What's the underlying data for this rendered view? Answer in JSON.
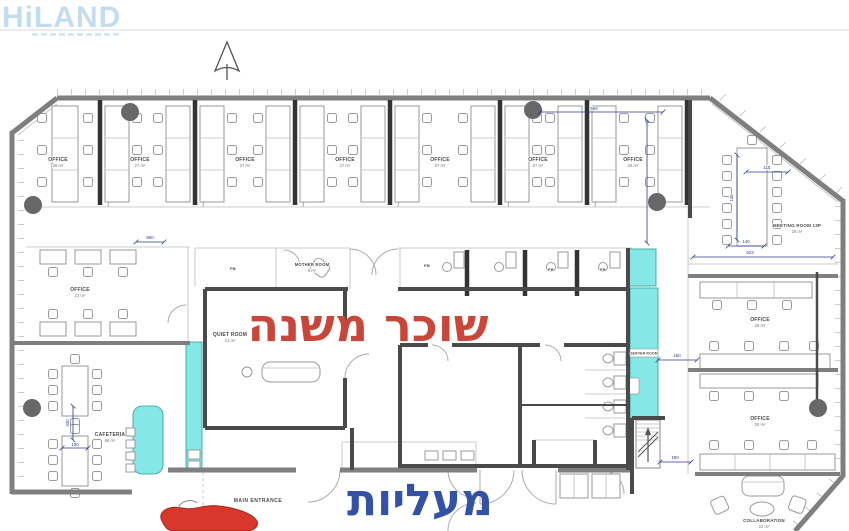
{
  "brand": {
    "logo": "HiLAND"
  },
  "overlay": {
    "subtenant": "שוכר משנה",
    "elevators": "מעליות"
  },
  "labels": {
    "main_entrance": "MAIN ENTRANCE",
    "pb": "PB",
    "top_offices": [
      {
        "name": "OFFICE",
        "area": "28 m²"
      },
      {
        "name": "OFFICE",
        "area": "27 m²"
      },
      {
        "name": "OFFICE",
        "area": "27 m²"
      },
      {
        "name": "OFFICE",
        "area": "27 m²"
      },
      {
        "name": "OFFICE",
        "area": "27 m²"
      },
      {
        "name": "OFFICE",
        "area": "27 m²"
      },
      {
        "name": "OFFICE",
        "area": "26 m²"
      }
    ],
    "meeting_room": {
      "name": "MEETING ROOM 13P",
      "area": "26 m²"
    },
    "left_office": {
      "name": "OFFICE",
      "area": "23 m²"
    },
    "mother_room": {
      "name": "MOTHER ROOM",
      "area": "5 m²"
    },
    "quiet_room": {
      "name": "QUIET ROOM",
      "area": "21 m²"
    },
    "server_room": {
      "name": "SERVER ROOM"
    },
    "cafeteria": {
      "name": "CAFETERIA",
      "area": "66 m²"
    },
    "right_offices": [
      {
        "name": "OFFICE",
        "area": "26 m²"
      },
      {
        "name": "OFFICE",
        "area": "26 m²"
      }
    ],
    "collaboration": {
      "name": "COLLABORATION",
      "area": "22 m²"
    }
  },
  "dimensions": {
    "top": "593",
    "vert": "",
    "meet_w": "115",
    "meet_d": "140",
    "meet_h": "146",
    "right_long": "623",
    "server": "150",
    "stairs": "150",
    "corridor": "500",
    "caf_v": "330",
    "caf_h": "100"
  },
  "colors": {
    "highlight_cyan": "#86e8e6",
    "overlay_red": "#c9473a",
    "overlay_blue": "#3352a5",
    "marker_red": "#d8382b",
    "watermark_blue": "#c3ddef"
  }
}
